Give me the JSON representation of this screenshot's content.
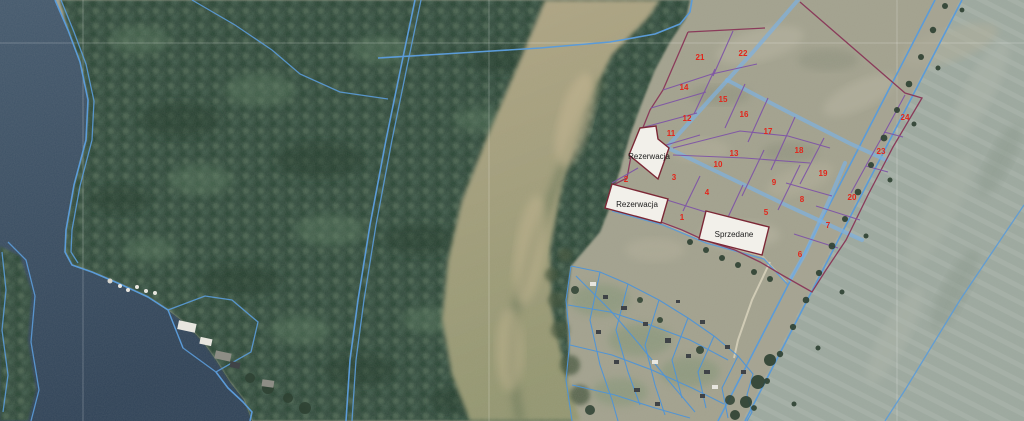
{
  "map": {
    "labels": {
      "reservation_top": "Rezerwacja",
      "reservation_left": "Rezerwacja",
      "sold": "Sprzedane"
    },
    "parcel_numbers": [
      {
        "label": "1"
      },
      {
        "label": "2"
      },
      {
        "label": "3"
      },
      {
        "label": "4"
      },
      {
        "label": "5"
      },
      {
        "label": "6"
      },
      {
        "label": "7"
      },
      {
        "label": "8"
      },
      {
        "label": "9"
      },
      {
        "label": "10"
      },
      {
        "label": "11"
      },
      {
        "label": "12"
      },
      {
        "label": "13"
      },
      {
        "label": "14"
      },
      {
        "label": "15"
      },
      {
        "label": "16"
      },
      {
        "label": "17"
      },
      {
        "label": "18"
      },
      {
        "label": "19"
      },
      {
        "label": "20"
      },
      {
        "label": "21"
      },
      {
        "label": "22"
      },
      {
        "label": "23"
      },
      {
        "label": "24"
      }
    ],
    "colors": {
      "water": "#44596d",
      "water-deep": "#2f4257",
      "forest": "#36503f",
      "marsh-top": "#b0a584",
      "marsh-bot": "#93966f",
      "field": "#a2a18d",
      "right-field": "#9ca89e",
      "road-fill": "#a8a695",
      "road-blue": "#7db1e0",
      "cadastral-blue": "#5b9bd8",
      "village-blue": "#4f94d6",
      "parcel-line": "#7e55a5",
      "boundary-line": "#8a3b5a",
      "label-bg": "#f2f0ea",
      "label-border": "#7c2836",
      "number-red": "#e2261b",
      "graticule": "#ffffff",
      "tree-dark": "#2e4132",
      "building-dark": "#3f4347",
      "building-light": "#e8e6df",
      "path-light": "#d8d2bc"
    }
  }
}
